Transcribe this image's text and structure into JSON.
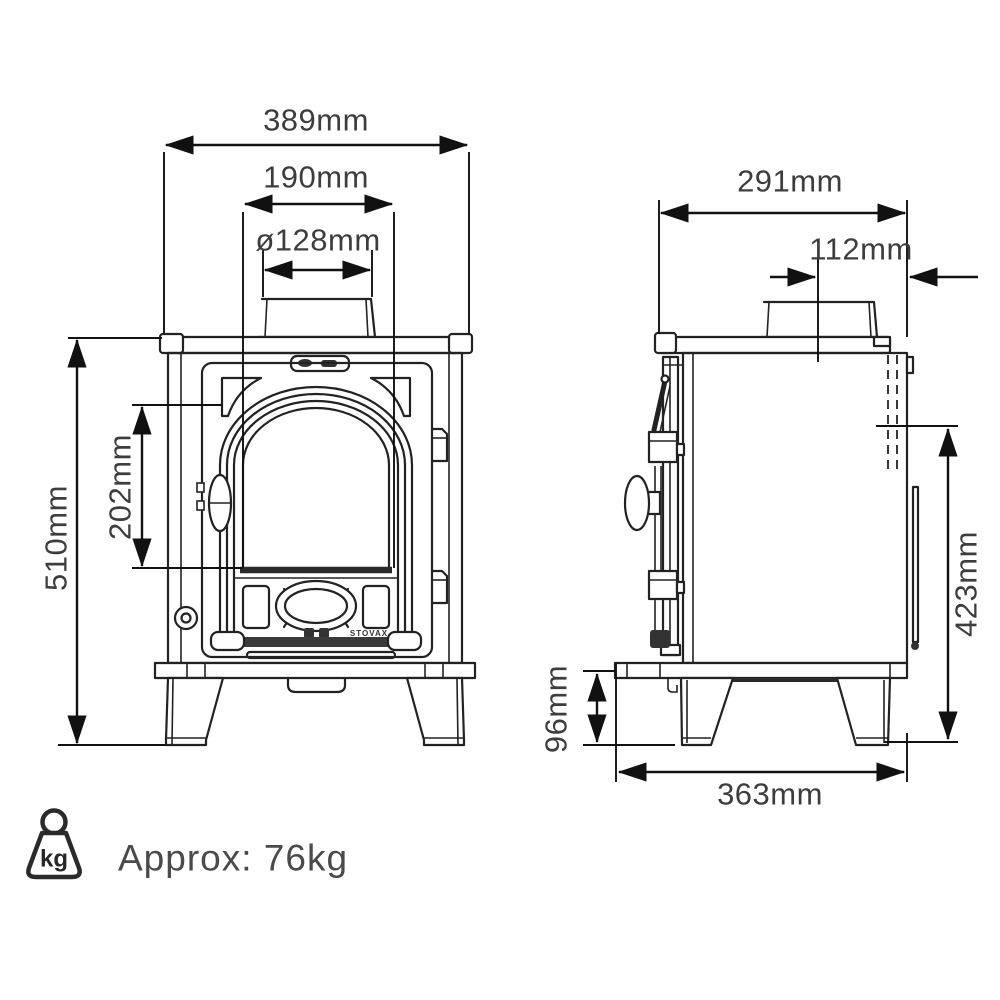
{
  "front_view": {
    "overall_width": "389mm",
    "top_plate_width": "190mm",
    "flue_diameter": "ø128mm",
    "overall_height": "510mm",
    "window_height": "202mm",
    "brand": "STOVAX"
  },
  "side_view": {
    "overall_depth": "291mm",
    "flue_centre_offset": "112mm",
    "rear_flue_height": "423mm",
    "clearance_height": "96mm",
    "base_depth": "363mm"
  },
  "weight": {
    "icon_unit": "kg",
    "label": "Approx: 76kg"
  },
  "colors": {
    "line": "#222222",
    "dimension": "#111111",
    "label": "#3d3d3d",
    "weight_label": "#4a4a4a"
  }
}
